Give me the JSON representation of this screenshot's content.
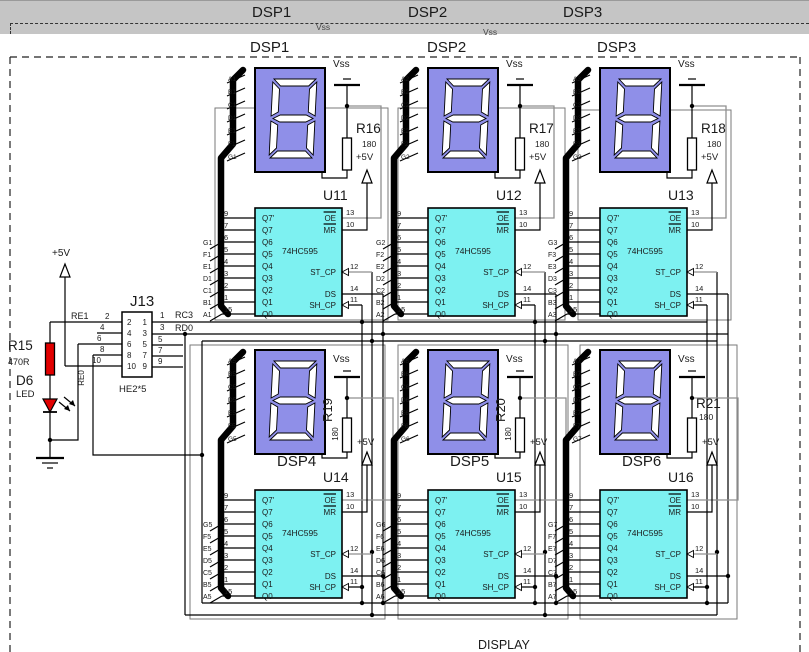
{
  "colors": {
    "display_fill": "#8f8fe8",
    "chip_fill": "#7df1f1",
    "resistor_red": "#e10000",
    "wire_gray": "#8f8f8f",
    "graybar": "#c5c5c5"
  },
  "top_bar": {
    "dsp_labels": [
      "DSP1",
      "DSP2",
      "DSP3"
    ],
    "vss": "Vss"
  },
  "header_labels": [
    "DSP1",
    "DSP2",
    "DSP3"
  ],
  "footer_label": "DISPLAY",
  "chip": {
    "part": "74HC595",
    "left_pin_numbers": [
      "9",
      "7",
      "6",
      "5",
      "4",
      "3",
      "2",
      "1",
      "15"
    ],
    "left_pin_names": [
      "Q7'",
      "Q7",
      "Q6",
      "Q5",
      "Q4",
      "Q3",
      "Q2",
      "Q1",
      "Q0"
    ],
    "right_pins": [
      {
        "name": "OE",
        "number": "13",
        "overline": true
      },
      {
        "name": "MR",
        "number": "10",
        "overline": true
      },
      {
        "name": "ST_CP",
        "number": "12",
        "clock": true
      },
      {
        "name": "DS",
        "number": "14",
        "clock": false
      },
      {
        "name": "SH_CP",
        "number": "11",
        "clock": true
      }
    ]
  },
  "units": [
    {
      "dsp": "DSP1",
      "ref": "U11",
      "res": "R16",
      "res_value": "180",
      "vss": "Vss",
      "v5": "+5V",
      "segments": [
        "A1",
        "B1",
        "C1",
        "D1",
        "E1",
        "F1",
        "G1"
      ]
    },
    {
      "dsp": "DSP2",
      "ref": "U12",
      "res": "R17",
      "res_value": "180",
      "vss": "Vss",
      "v5": "+5V",
      "segments": [
        "A2",
        "B2",
        "C2",
        "D2",
        "E2",
        "F2",
        "G2"
      ]
    },
    {
      "dsp": "DSP3",
      "ref": "U13",
      "res": "R18",
      "res_value": "180",
      "vss": "Vss",
      "v5": "+5V",
      "segments": [
        "A3",
        "B3",
        "C3",
        "D3",
        "E3",
        "F3",
        "G3"
      ]
    },
    {
      "dsp": "DSP4",
      "ref": "U14",
      "res": "R19",
      "res_value": "180",
      "vss": "Vss",
      "v5": "+5V",
      "segments": [
        "A5",
        "B5",
        "C5",
        "D5",
        "E5",
        "F5",
        "G5"
      ]
    },
    {
      "dsp": "DSP5",
      "ref": "U15",
      "res": "R20",
      "res_value": "180",
      "vss": "Vss",
      "v5": "+5V",
      "segments": [
        "A6",
        "B6",
        "C6",
        "D6",
        "E6",
        "F6",
        "G6"
      ]
    },
    {
      "dsp": "DSP6",
      "ref": "U16",
      "res": "R21",
      "res_value": "180",
      "vss": "Vss",
      "v5": "+5V",
      "segments": [
        "A7",
        "B7",
        "C7",
        "D7",
        "E7",
        "F7",
        "G7"
      ]
    }
  ],
  "connector": {
    "ref": "J13",
    "type": "HE2*5",
    "left_pins": [
      "2",
      "4",
      "6",
      "8",
      "10"
    ],
    "right_pins": [
      "1",
      "3",
      "5",
      "7",
      "9"
    ],
    "signals": {
      "re1": "RE1",
      "rc3": "RC3",
      "rd0": "RD0",
      "re0": "RE0"
    },
    "v5": "+5V"
  },
  "r15": {
    "ref": "R15",
    "value": "470R"
  },
  "d6": {
    "ref": "D6",
    "type": "LED"
  }
}
